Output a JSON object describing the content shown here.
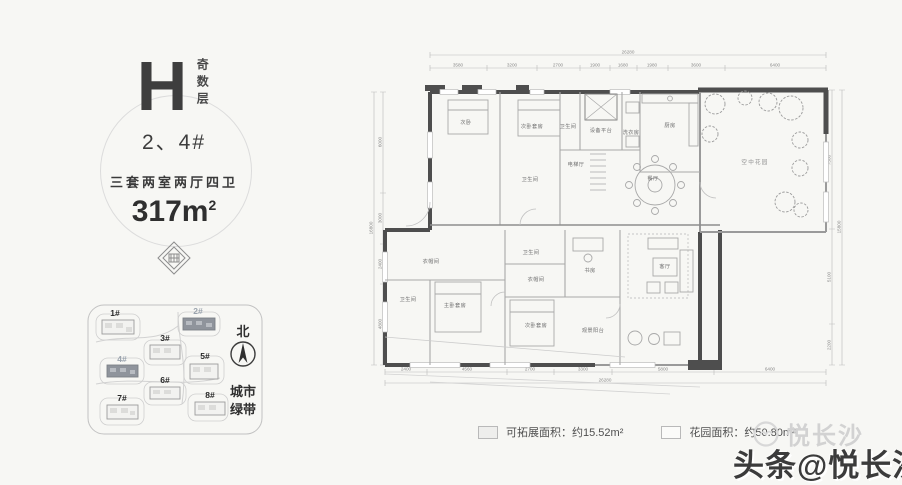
{
  "info_panel": {
    "plan_letter": "H",
    "floor_note": "奇数层",
    "buildings": "2、4#",
    "layout_desc": "三套两室两厅四卫",
    "area_value": "317m",
    "area_sup": "2"
  },
  "site_plan": {
    "north_label": "北",
    "green_belt_line1": "城市",
    "green_belt_line2": "绿带",
    "buildings": [
      {
        "label": "1#",
        "highlighted": false
      },
      {
        "label": "2#",
        "highlighted": true
      },
      {
        "label": "3#",
        "highlighted": false
      },
      {
        "label": "4#",
        "highlighted": true
      },
      {
        "label": "5#",
        "highlighted": false
      },
      {
        "label": "6#",
        "highlighted": false
      },
      {
        "label": "7#",
        "highlighted": false
      },
      {
        "label": "8#",
        "highlighted": false
      }
    ]
  },
  "floor_plan": {
    "rooms": [
      {
        "label": "次卧"
      },
      {
        "label": "次卧套房"
      },
      {
        "label": "卫生间"
      },
      {
        "label": "设备平台"
      },
      {
        "label": "洗衣房"
      },
      {
        "label": "厨房"
      },
      {
        "label": "电梯厅"
      },
      {
        "label": "餐厅"
      },
      {
        "label": "空中花园"
      },
      {
        "label": "卫生间"
      },
      {
        "label": "衣帽间"
      },
      {
        "label": "卫生间"
      },
      {
        "label": "主卧套房"
      },
      {
        "label": "卫生间"
      },
      {
        "label": "衣帽间"
      },
      {
        "label": "书房"
      },
      {
        "label": "次卧套房"
      },
      {
        "label": "客厅"
      },
      {
        "label": "观景阳台"
      }
    ],
    "dims_top": {
      "total": "26280",
      "segments": [
        "3580",
        "3200",
        "2700",
        "1900",
        "1680",
        "1980",
        "3600",
        "6400"
      ]
    },
    "dims_bottom": {
      "total": "26280",
      "segments": [
        "2400",
        "4560",
        "2700",
        "3300",
        "5800",
        "6400"
      ]
    },
    "dims_left": {
      "total": "16800",
      "segments": [
        "6000",
        "3000",
        "2400",
        "4800"
      ]
    },
    "dims_right": {
      "total": "15800",
      "segments": [
        "7500",
        "5100",
        "2200"
      ]
    }
  },
  "legend": {
    "items": [
      {
        "label": "可拓展面积：约15.52m²"
      },
      {
        "label": "花园面积：约50.80m²"
      }
    ]
  },
  "watermark": {
    "brand_small": "悦长沙",
    "brand_big": "头条@悦长沙"
  }
}
